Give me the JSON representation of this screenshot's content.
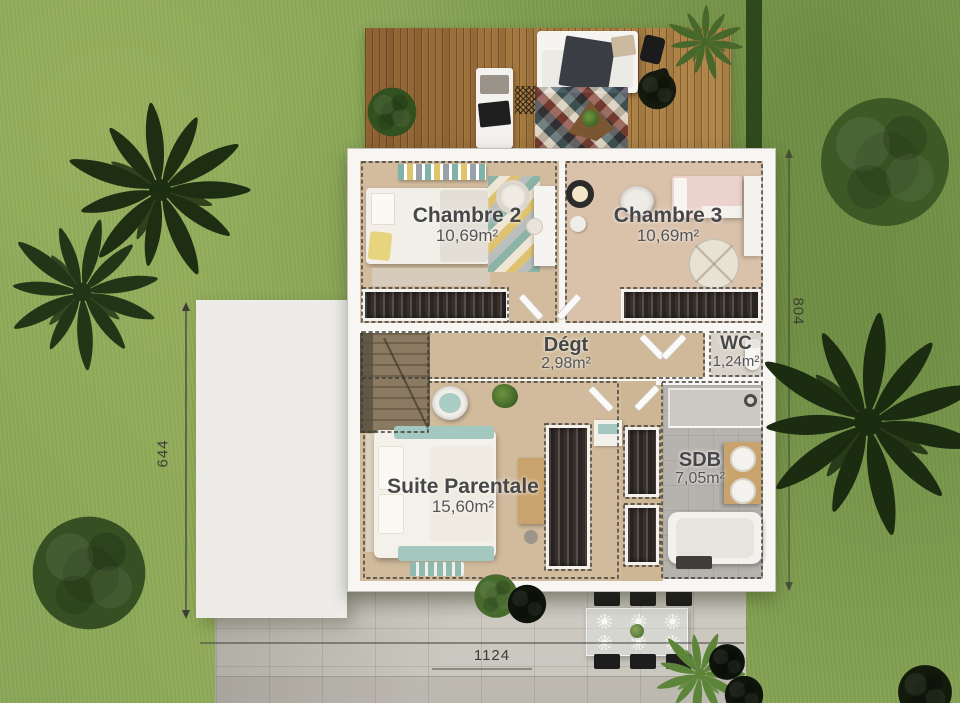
{
  "scene": "architectural-floor-plan-top-view",
  "rooms": [
    {
      "name": "Chambre 2",
      "area": "10,69m²"
    },
    {
      "name": "Chambre 3",
      "area": "10,69m²"
    },
    {
      "name": "Dégt",
      "area": "2,98m²"
    },
    {
      "name": "WC",
      "area": "1,24m²"
    },
    {
      "name": "Suite Parentale",
      "area": "15,60m²"
    },
    {
      "name": "SDB",
      "area": "7,05m²"
    }
  ],
  "dimensions": {
    "left": "644",
    "right": "804",
    "bottom": "1124"
  },
  "colors": {
    "grass": "#87a455",
    "deck_wood": "#9c7342",
    "wall_white": "#f7f6f3",
    "floor_wood": "#d2bb9d",
    "floor_tile": "#b6b2ad",
    "concrete": "#cdcac2",
    "closet_dark": "#2b2623",
    "accent_teal": "#a3c8c0",
    "label_text": "#474747"
  }
}
